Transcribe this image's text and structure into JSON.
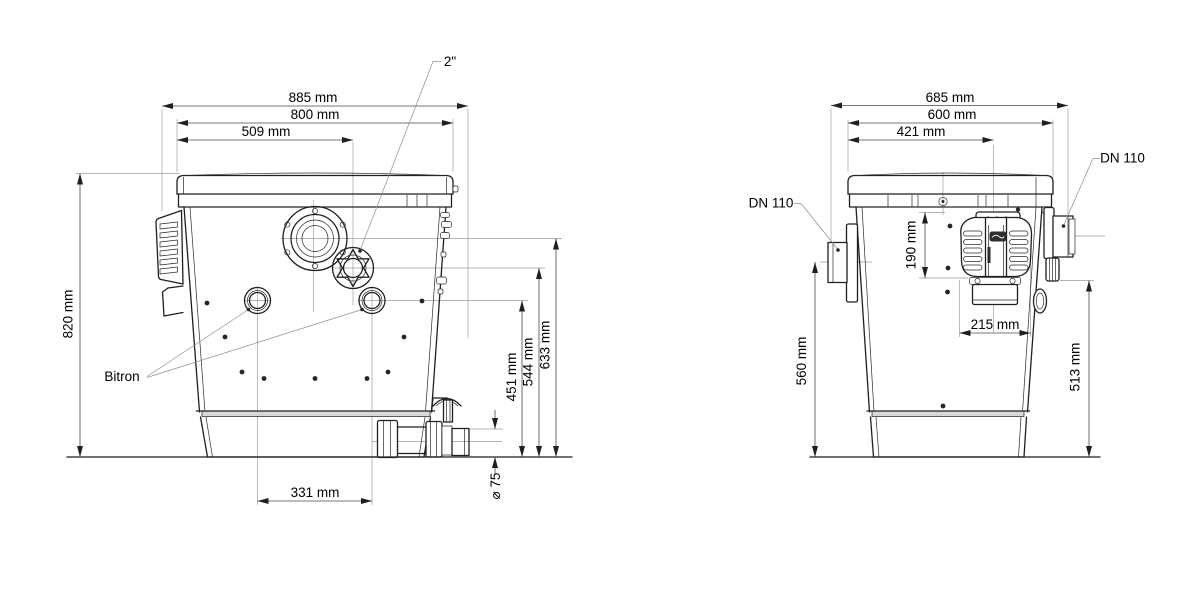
{
  "colors": {
    "background": "#ffffff",
    "line": "#1f1f1f",
    "dim_line": "#4a4a4a",
    "extension_line": "#9a9a9a",
    "text": "#000000",
    "rim_fill": "#d8d8d8",
    "badge_fill": "#2e2e2e"
  },
  "front_view": {
    "dims": {
      "overall_width": "885 mm",
      "lid_width": "800 mm",
      "fitting_offset": "509 mm",
      "overall_height": "820 mm",
      "bitron_port_height": "451 mm",
      "fitting_height": "544 mm",
      "flange_height": "633 mm",
      "port_spacing": "331 mm",
      "drain_diameter": "⌀ 75"
    },
    "callouts": {
      "fitting": "2\"",
      "uvc": "Bitron"
    }
  },
  "side_view": {
    "dims": {
      "overall_width": "685 mm",
      "lid_width": "600 mm",
      "center_offset": "421 mm",
      "controller_height": "190 mm",
      "controller_width": "215 mm",
      "inlet_height": "560 mm",
      "outlet_height": "513 mm"
    },
    "callouts": {
      "inlet_left": "DN 110",
      "inlet_right": "DN 110"
    }
  }
}
